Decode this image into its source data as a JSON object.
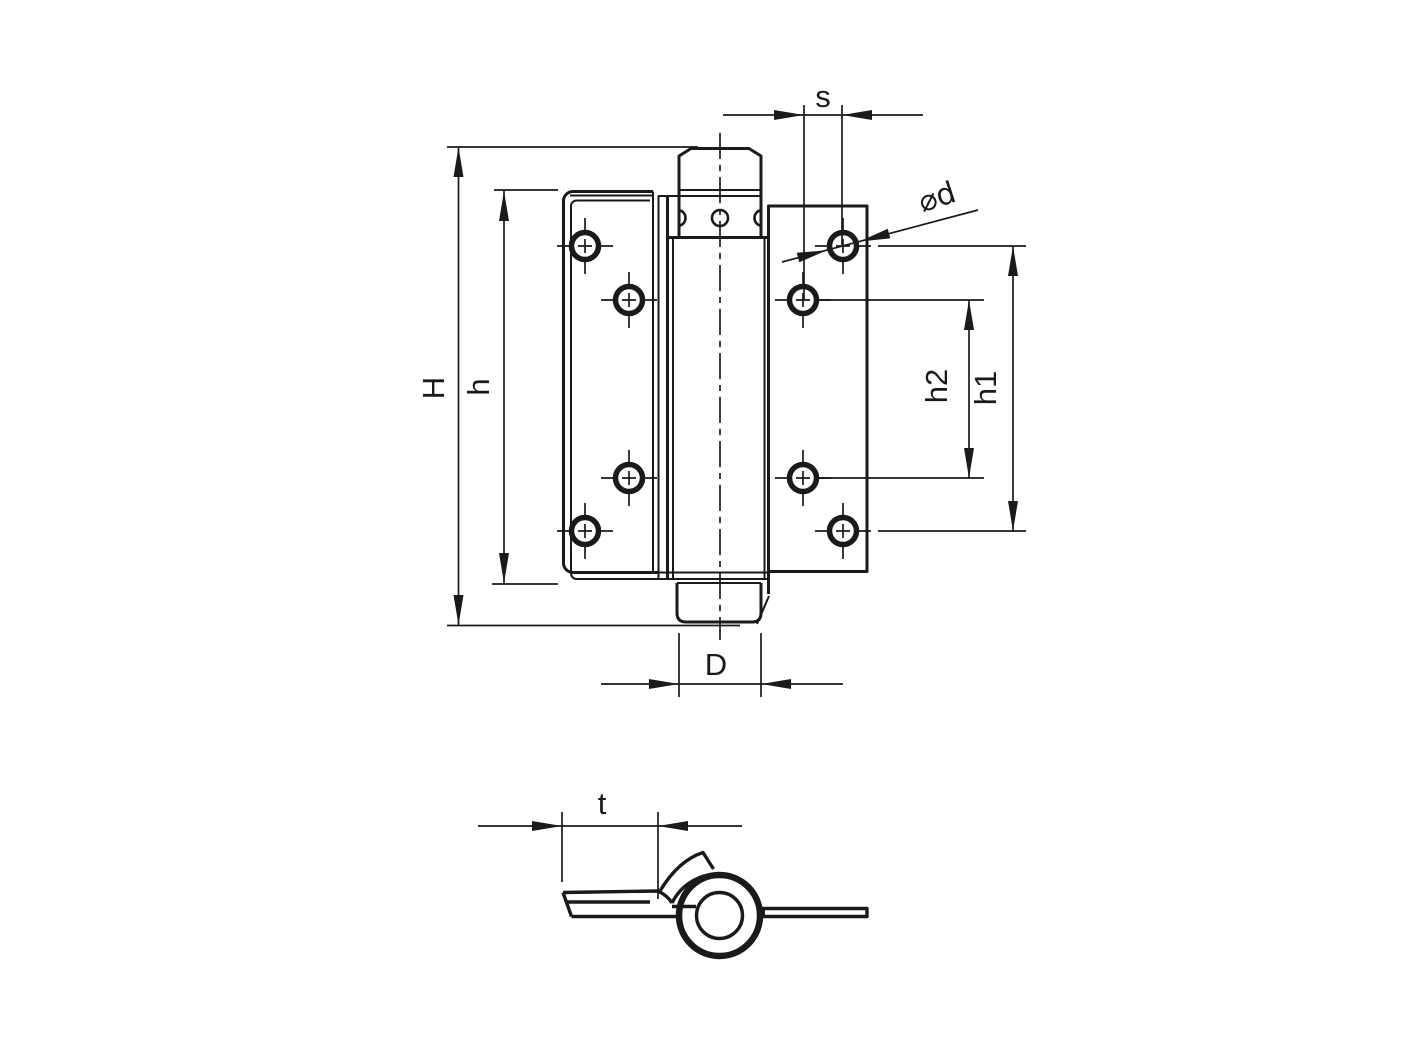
{
  "canvas": {
    "background": "#ffffff",
    "line_color": "#1a1a1a",
    "kind": "technical dimension drawing, spring door hinge"
  },
  "views": [
    {
      "id": "front-view",
      "holes_left_leaf": 4,
      "holes_right_leaf": 4,
      "dimension_labels": [
        "s",
        "⌀d",
        "H",
        "h",
        "h2",
        "h1",
        "D"
      ]
    },
    {
      "id": "side-view",
      "dimension_labels": [
        "t"
      ]
    }
  ],
  "labels": {
    "s": "s",
    "diameter": "⌀d",
    "H": "H",
    "h": "h",
    "h2": "h2",
    "h1": "h1",
    "D": "D",
    "t": "t"
  }
}
